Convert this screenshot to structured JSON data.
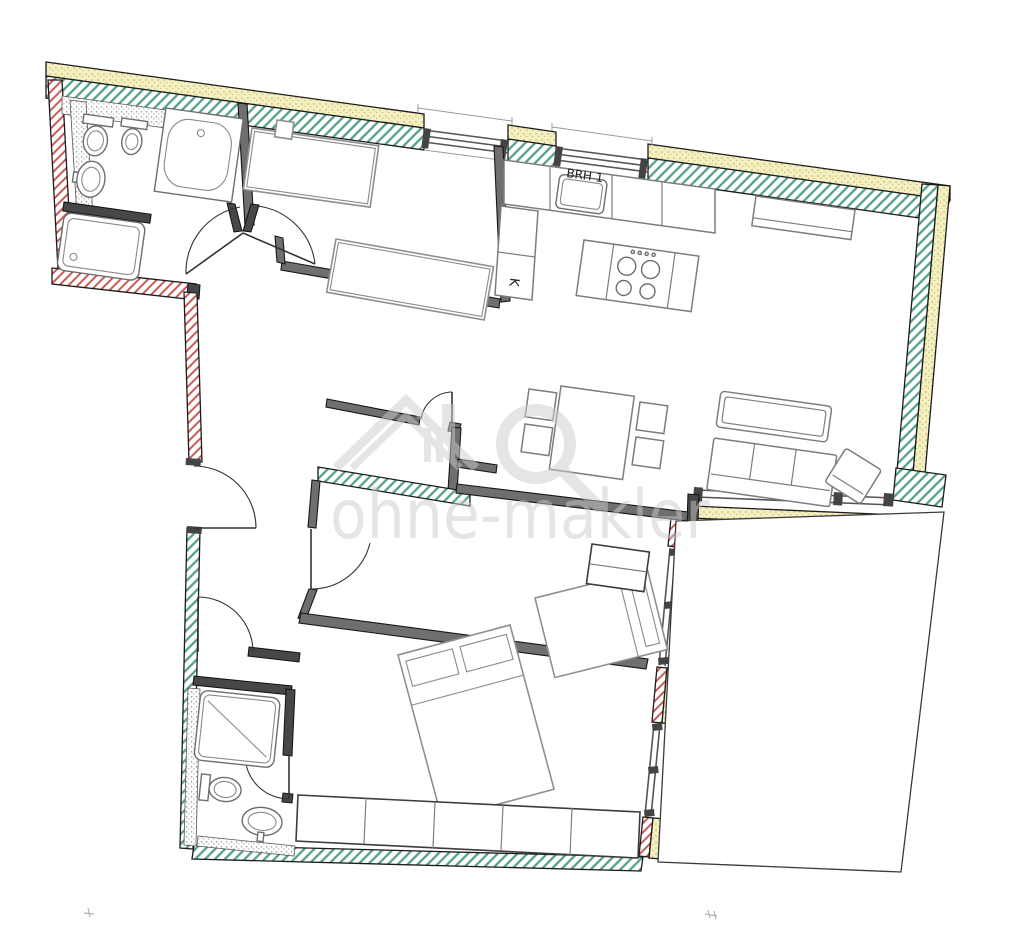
{
  "plan": {
    "labels": {
      "parapet": "BRH 1",
      "fridge": "K"
    },
    "watermark": {
      "text": "ohne-makler"
    },
    "colors": {
      "c-green": "#55a08c",
      "c-red": "#c4534c",
      "c-yellow": "#f4f0c2",
      "c-yellow-dot": "#c5bc74",
      "c-wall-dark": "#6f6f6f",
      "c-line": "#1b1b1b",
      "c-watermark": "#cccccc"
    }
  }
}
